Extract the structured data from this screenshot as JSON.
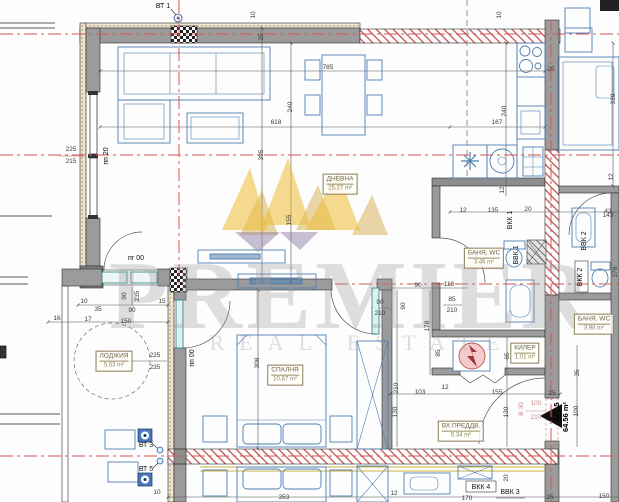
{
  "watermark": {
    "title": "PREMIER",
    "subtitle": "REAL ESTATE"
  },
  "apartment": {
    "number": "АП. 5",
    "area": "64.56 m²"
  },
  "rooms": [
    {
      "name": "ДНЕВНА",
      "area": "25.27 m²",
      "x": 340,
      "y": 184
    },
    {
      "name": "ЛОДЖИЯ",
      "area": "5.63 m²",
      "x": 114,
      "y": 361
    },
    {
      "name": "СПАЛНЯ",
      "area": "10.87 m²",
      "x": 285,
      "y": 375
    },
    {
      "name": "БАНЯ, WC",
      "area": "3.46 m²",
      "x": 484,
      "y": 258
    },
    {
      "name": "КИЛЕР",
      "area": "1.01 m²",
      "x": 525,
      "y": 353
    },
    {
      "name": "ВХ.ПРЕДДВ.",
      "area": "5.34 m²",
      "x": 461,
      "y": 431
    },
    {
      "name": "БАНЯ, WC",
      "area": "3.98 m²",
      "x": 594,
      "y": 324
    }
  ],
  "annotations": [
    {
      "t": "ВТ 1",
      "x": 163,
      "y": 8,
      "c": "marker"
    },
    {
      "t": "10",
      "x": 255,
      "y": 15,
      "r": 1
    },
    {
      "t": "25",
      "x": 263,
      "y": 37,
      "r": 1
    },
    {
      "t": "785",
      "x": 328,
      "y": 69
    },
    {
      "t": "618",
      "x": 276,
      "y": 124
    },
    {
      "t": "167",
      "x": 497,
      "y": 124
    },
    {
      "t": "10",
      "x": 501,
      "y": 15,
      "r": 1
    },
    {
      "t": "240",
      "x": 506,
      "y": 111,
      "r": 1
    },
    {
      "t": "25",
      "x": 551,
      "y": 71
    },
    {
      "t": "240",
      "x": 292,
      "y": 107,
      "r": 1
    },
    {
      "t": "395",
      "x": 263,
      "y": 155,
      "r": 1
    },
    {
      "t": "155",
      "x": 291,
      "y": 220,
      "r": 1
    },
    {
      "t": "225",
      "x": 71,
      "y": 151
    },
    {
      "t": "215",
      "x": 71,
      "y": 163
    },
    {
      "t": "пп 20",
      "x": 108,
      "y": 156,
      "r": 1,
      "c": "marker"
    },
    {
      "t": "310",
      "x": 615,
      "y": 99,
      "r": 1
    },
    {
      "t": "12",
      "x": 613,
      "y": 177,
      "r": 1
    },
    {
      "t": "12",
      "x": 504,
      "y": 190,
      "r": 1
    },
    {
      "t": "12",
      "x": 463,
      "y": 212
    },
    {
      "t": "135",
      "x": 493,
      "y": 212
    },
    {
      "t": "ВКК 1",
      "x": 512,
      "y": 220,
      "r": 1,
      "c": "marker"
    },
    {
      "t": "20",
      "x": 528,
      "y": 211
    },
    {
      "t": "43",
      "x": 608,
      "y": 213
    },
    {
      "t": "ВВК 1",
      "x": 518,
      "y": 255,
      "r": 1,
      "c": "marker"
    },
    {
      "t": "ВВК 2",
      "x": 586,
      "y": 241,
      "r": 1,
      "c": "marker"
    },
    {
      "t": "ВКК 2",
      "x": 582,
      "y": 277,
      "r": 1,
      "c": "marker"
    },
    {
      "t": "143",
      "x": 608,
      "y": 217
    },
    {
      "t": "85",
      "x": 452,
      "y": 301
    },
    {
      "t": "210",
      "x": 452,
      "y": 312
    },
    {
      "t": "90",
      "x": 380,
      "y": 304
    },
    {
      "t": "210",
      "x": 380,
      "y": 315
    },
    {
      "t": "90",
      "x": 418,
      "y": 287
    },
    {
      "t": "118",
      "x": 449,
      "y": 286
    },
    {
      "t": "90",
      "x": 405,
      "y": 306,
      "r": 1
    },
    {
      "t": "178",
      "x": 429,
      "y": 326,
      "r": 1
    },
    {
      "t": "85",
      "x": 440,
      "y": 353,
      "r": 1
    },
    {
      "t": "90",
      "x": 126,
      "y": 296,
      "r": 1
    },
    {
      "t": "235",
      "x": 139,
      "y": 296,
      "r": 1
    },
    {
      "t": "пг 00",
      "x": 136,
      "y": 260,
      "c": "marker"
    },
    {
      "t": "10",
      "x": 84,
      "y": 303
    },
    {
      "t": "35",
      "x": 98,
      "y": 311
    },
    {
      "t": "90",
      "x": 132,
      "y": 312
    },
    {
      "t": "15",
      "x": 162,
      "y": 303
    },
    {
      "t": "16",
      "x": 57,
      "y": 320
    },
    {
      "t": "17",
      "x": 88,
      "y": 321
    },
    {
      "t": "150",
      "x": 126,
      "y": 323
    },
    {
      "t": "225",
      "x": 155,
      "y": 357
    },
    {
      "t": "235",
      "x": 155,
      "y": 369
    },
    {
      "t": "пп 00",
      "x": 194,
      "y": 358,
      "r": 1,
      "c": "marker"
    },
    {
      "t": "308",
      "x": 259,
      "y": 363,
      "r": 1
    },
    {
      "t": "ВТ 3",
      "x": 146,
      "y": 447,
      "c": "marker"
    },
    {
      "t": "ВТ 5",
      "x": 146,
      "y": 471,
      "c": "marker"
    },
    {
      "t": "10",
      "x": 157,
      "y": 494
    },
    {
      "t": "353",
      "x": 284,
      "y": 499
    },
    {
      "t": "12",
      "x": 394,
      "y": 495
    },
    {
      "t": "170",
      "x": 467,
      "y": 500
    },
    {
      "t": "25",
      "x": 550,
      "y": 499
    },
    {
      "t": "150",
      "x": 604,
      "y": 498
    },
    {
      "t": "210",
      "x": 398,
      "y": 388,
      "r": 1
    },
    {
      "t": "103",
      "x": 420,
      "y": 394
    },
    {
      "t": "130",
      "x": 397,
      "y": 412,
      "r": 1
    },
    {
      "t": "155",
      "x": 497,
      "y": 394
    },
    {
      "t": "130",
      "x": 508,
      "y": 412,
      "r": 1
    },
    {
      "t": "12",
      "x": 445,
      "y": 389
    },
    {
      "t": "25",
      "x": 552,
      "y": 395
    },
    {
      "t": "65",
      "x": 509,
      "y": 356,
      "r": 1
    },
    {
      "t": "35",
      "x": 579,
      "y": 373,
      "r": 1
    },
    {
      "t": "100",
      "x": 578,
      "y": 411,
      "r": 1
    },
    {
      "t": "В 30",
      "x": 523,
      "y": 409,
      "r": 1,
      "c": "pink"
    },
    {
      "t": "100",
      "x": 536,
      "y": 405,
      "c": "pink"
    },
    {
      "t": "210",
      "x": 536,
      "y": 419,
      "c": "pink"
    },
    {
      "t": "ВКК 4",
      "x": 481,
      "y": 489,
      "c": "marker"
    },
    {
      "t": "ВВК 3",
      "x": 510,
      "y": 494,
      "c": "marker"
    },
    {
      "t": "20",
      "x": 508,
      "y": 478,
      "r": 1
    },
    {
      "t": "278",
      "x": 617,
      "y": 272,
      "r": 1
    }
  ]
}
